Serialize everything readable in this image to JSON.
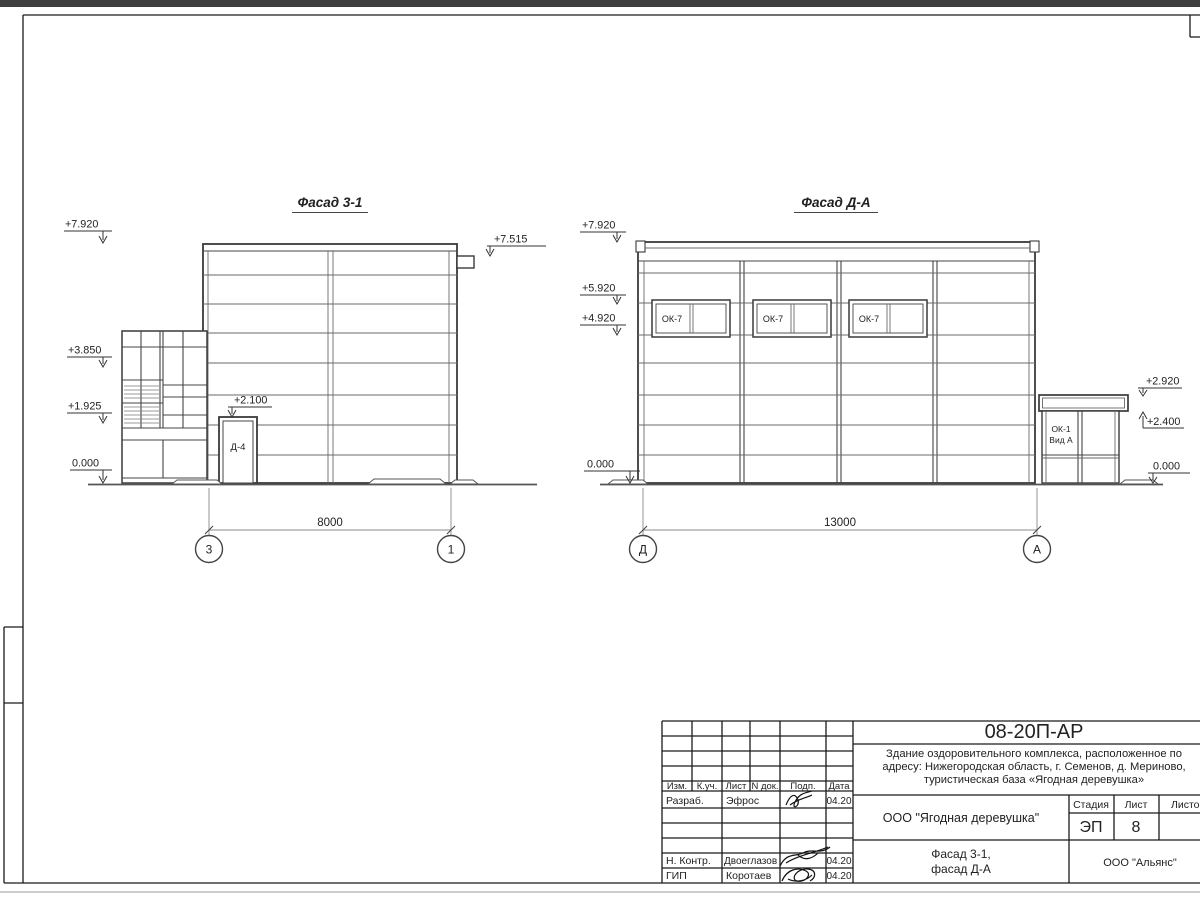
{
  "facade_left": {
    "title": "Фасад 3-1",
    "door_label": "Д-4",
    "dimension": "8000",
    "axis_left": "3",
    "axis_right": "1",
    "elev_top": "+7.920",
    "elev_scupper": "+7.515",
    "elev_mid": "+3.850",
    "elev_low": "+1.925",
    "elev_ground": "0.000",
    "elev_door": "+2.100"
  },
  "facade_right": {
    "title": "Фасад Д-А",
    "dimension": "13000",
    "axis_left": "Д",
    "axis_right": "А",
    "windows": [
      {
        "label": "ОК-7"
      },
      {
        "label": "ОК-7"
      },
      {
        "label": "ОК-7"
      }
    ],
    "vestibule_label1": "ОК-1",
    "vestibule_label2": "Вид А",
    "elev_top": "+7.920",
    "elev_upper": "+5.920",
    "elev_sill": "+4.920",
    "elev_ground_left": "0.000",
    "elev_canopy_top": "+2.920",
    "elev_canopy_bottom": "+2.400",
    "elev_ground_right": "0.000"
  },
  "title_block": {
    "doc_number": "08-20П-АР",
    "project_line1": "Здание оздоровительного комплекса, расположенное по",
    "project_line2": "адресу: Нижегородская область, г. Семенов, д. Мериново,",
    "project_line3": "туристическая база «Ягодная деревушка»",
    "client": "ООО \"Ягодная деревушка\"",
    "stage_label": "Стадия",
    "sheet_label": "Лист",
    "sheets_label": "Листов",
    "stage_value": "ЭП",
    "sheet_value": "8",
    "drawing_title_line1": "Фасад 3-1,",
    "drawing_title_line2": "фасад Д-А",
    "contractor": "ООО \"Альянс\"",
    "cols": {
      "c1": "Изм.",
      "c2": "К.уч.",
      "c3": "Лист",
      "c4": "N док.",
      "c5": "Подп.",
      "c6": "Дата"
    },
    "row_razrab": {
      "role": "Разраб.",
      "name": "Эфрос",
      "date": "04.20"
    },
    "row_nkontr": {
      "role": "Н. Контр.",
      "name": "Двоеглазов",
      "date": "04.20"
    },
    "row_gip": {
      "role": "ГИП",
      "name": "Коротаев",
      "date": "04.20"
    }
  }
}
